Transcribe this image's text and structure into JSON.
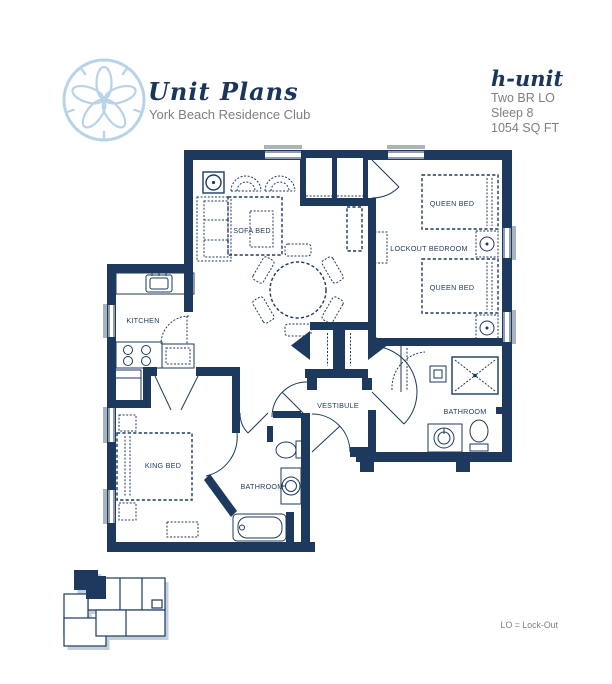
{
  "header": {
    "title": "Unit Plans",
    "subtitle": "York Beach Residence Club",
    "logo_icon": "sand-dollar-icon"
  },
  "unit_info": {
    "name": "h-unit",
    "type": "Two BR LO",
    "sleeps": "Sleep 8",
    "area": "1054 SQ FT"
  },
  "rooms": {
    "sofa_bed": "SOFA BED",
    "kitchen": "KITCHEN",
    "king_bed": "KING BED",
    "bathroom_main": "BATHROOM",
    "vestibule": "VESTIBULE",
    "lockout_bedroom": "LOCKOUT BEDROOM",
    "queen_bed_top": "QUEEN BED",
    "queen_bed_bottom": "QUEEN BED",
    "bathroom_lockout": "BATHROOM"
  },
  "legend": {
    "note": "LO = Lock-Out"
  },
  "colors": {
    "wall_navy": "#1d3a5e",
    "logo_blue": "#b7d3e8",
    "text_gray": "#7d7f83",
    "window_sill_gray": "#a9b4bd",
    "keyplan_shadow": "#c3cfda"
  }
}
